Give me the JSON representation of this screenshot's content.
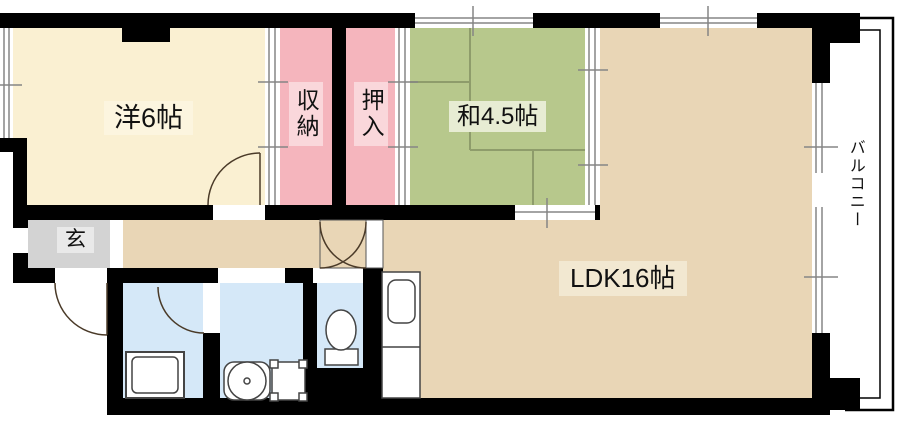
{
  "floorplan": {
    "labels": {
      "western_room": "洋6帖",
      "storage": "収納",
      "closet": "押入",
      "japanese_room": "和4.5帖",
      "ldk": "LDK16帖",
      "entrance": "玄",
      "balcony": "バルコニー"
    },
    "colors": {
      "wall": "#000000",
      "western_room": "#FAF0D2",
      "storage": "#F5B5BD",
      "closet": "#F5B5BD",
      "japanese_room": "#B7C88C",
      "ldk": "#E9D6B6",
      "entrance": "#D3D3D3",
      "wet_area": "#D5E8F8",
      "tatami_line": "#8E9C6B",
      "window_line": "#858585",
      "fixture_line": "#444444",
      "door_line": "#4a3a28",
      "label_bg_western": "#FCF5DF",
      "label_bg_storage": "#FAD7DB",
      "label_bg_japanese": "#E7ECD3",
      "label_bg_ldk": "#F2E8D1",
      "label_bg_entrance": "#E9E9E9"
    }
  }
}
